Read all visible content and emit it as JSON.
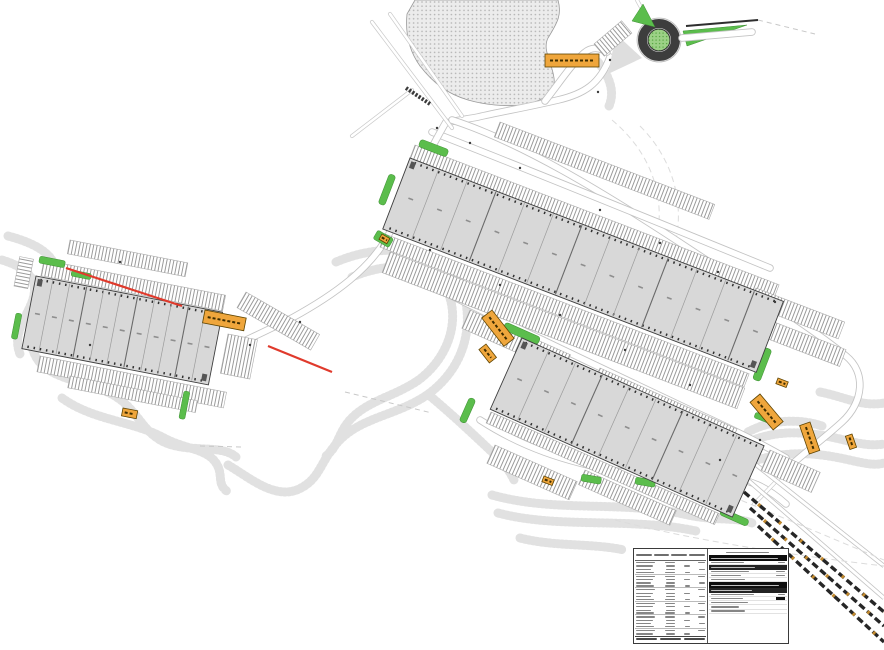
{
  "canvas": {
    "width": 884,
    "height": 650,
    "background": "#ffffff"
  },
  "palette": {
    "building_fill": "#d8d8d8",
    "building_outline": "#3e3e3e",
    "parking_stripe": "#909090",
    "landscape_green": "#5bbd4c",
    "roundabout_island_green": "#9cd186",
    "marker_orange": "#efa63c",
    "phase_line_red": "#e03a2c",
    "slope_hatch_gray": "#e1e1e1",
    "road_edge_gray": "#c3c3c3",
    "rail_train_black": "#262626",
    "table_header_black": "#0d0d0d"
  },
  "buildings": [
    {
      "name": "warehouse-north",
      "units": 13
    },
    {
      "name": "warehouse-south",
      "units": 9
    },
    {
      "name": "warehouse-west",
      "units": 11
    }
  ],
  "roundabout": {
    "green_islands": 2
  },
  "markers": {
    "orange_labels": 11
  },
  "railway": {
    "sidings_with_trains": 3
  },
  "schedule_table": {
    "left": {
      "rows": 22,
      "columns": 4
    },
    "right": {
      "black_section_bars": 3
    }
  }
}
